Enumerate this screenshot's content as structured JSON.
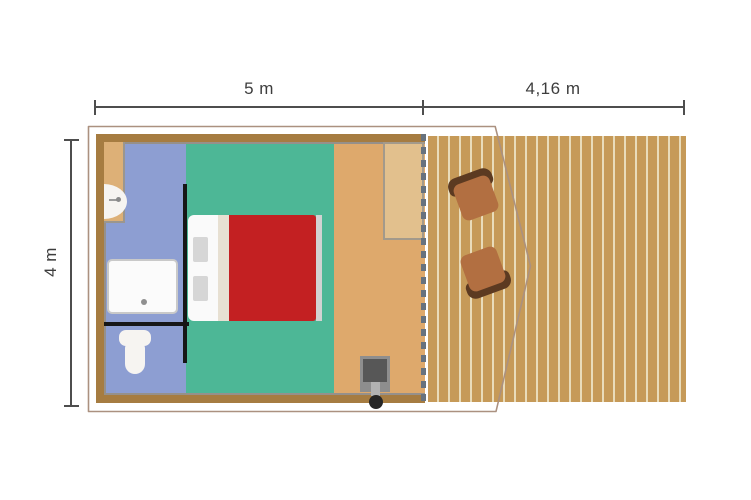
{
  "title": "Safari tent floor plan with deck",
  "dimensions": {
    "tent_width": {
      "label": "5 m"
    },
    "deck_width": {
      "label": "4,16 m"
    },
    "tent_depth": {
      "label": "4 m"
    }
  },
  "rooms": {
    "bathroom": {
      "name": "bathroom",
      "color": "#8d9ed2"
    },
    "bedroom": {
      "name": "bedroom",
      "color": "#4db796"
    },
    "living": {
      "name": "living area",
      "color": "#dea96c"
    },
    "deck": {
      "name": "wooden deck",
      "color": "#c69a58"
    }
  },
  "furniture": [
    "washbasin",
    "shower-tray",
    "toilet",
    "double-bed",
    "sideboard",
    "wood-stove",
    "deck-chair",
    "deck-chair"
  ],
  "colors": {
    "wall": "#a67c41",
    "outline": "#ab9180",
    "bathroom": "#8d9ed2",
    "bedroom": "#4db796",
    "living": "#dea96c",
    "vanity": "#ddb077",
    "sideboard": "#e2c08d",
    "deck_plank": "#c69a58",
    "deck_gap": "#e9dcba",
    "partition": "#161616",
    "bed_red": "#c32022",
    "bed_white": "#fafafa",
    "bed_fold": "#e7e0d2",
    "bed_foot": "#d2d2d2",
    "pillow": "#d6d6d6",
    "fixture": "#f6f4f1",
    "chair_seat": "#b26f41",
    "chair_back": "#5c3a21",
    "stove_outer": "#8e8e8e",
    "stove_inner": "#575757",
    "stove_pipe": "#b2b2b2",
    "stove_dot": "#262626",
    "dash": "#67727e",
    "dim_line": "#4e4e4e",
    "dim_text": "#3d3d3d"
  }
}
